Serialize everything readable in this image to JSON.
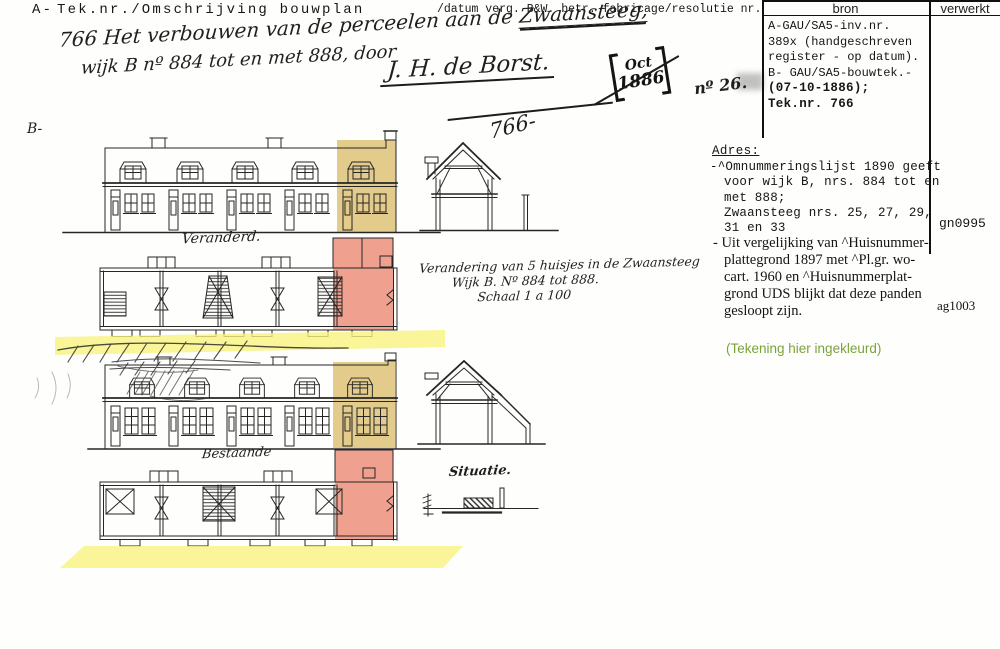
{
  "colors": {
    "highlight_yellow": "#f7f37e",
    "highlight_tan": "#e2cb8b",
    "highlight_red": "#efa08e",
    "note_green": "#7ba33b",
    "ink": "#262626"
  },
  "header": {
    "left_label": "A-",
    "left_title": "Tek.nr./Omschrijving bouwplan",
    "right_title": "/datum verg. B&W. betr. fabricage/resolutie nr."
  },
  "registration": {
    "line1_text": "766 Het verbouwen van de perceelen aan de ",
    "line1_underlined": "Zwaansteeg,",
    "line2": "wijk B nº 884 tot en met 888, door",
    "signature": "J. H. de Borst.",
    "stamp": {
      "month": "Oct",
      "year": "1886",
      "number": "nº 26."
    }
  },
  "source_table": {
    "col1_header": "bron",
    "col2_header": "verwerkt",
    "bron_lines": [
      "A-GAU/SA5-inv.nr.",
      "389x (handgeschreven",
      "register - op datum).",
      "B- GAU/SA5-bouwtek.-",
      "(07-10-1886);",
      "Tek.nr. 766"
    ]
  },
  "notes": {
    "adres_heading": "Adres:",
    "note1_lines": [
      "-^Omnummeringslijst 1890 geeft",
      "voor wijk B, nrs. 884 tot en",
      "met 888;",
      "Zwaansteeg nrs. 25, 27, 29,",
      "31 en 33"
    ],
    "code1": "gn0995",
    "note2_lines": [
      "- Uit vergelijking van ^Huisnummer-",
      "plattegrond 1897 met ^Pl.gr. wo-",
      "cart. 1960 en ^Huisnummerplat-",
      "grond UDS blijkt dat deze panden",
      "gesloopt zijn."
    ],
    "code2": "ag1003",
    "colored_note": "(Tekening hier ingekleurd)"
  },
  "drawing": {
    "section_label": "B-",
    "sheet_number": "766-",
    "caption_changed": "Veranderd.",
    "caption_existing": "Bestaande",
    "caption_situation": "Situatie.",
    "title_lines": [
      "Verandering van 5 huisjes in de Zwaansteeg",
      "Wijk B. Nº 884 tot 888.",
      "Schaal 1 a 100"
    ]
  }
}
